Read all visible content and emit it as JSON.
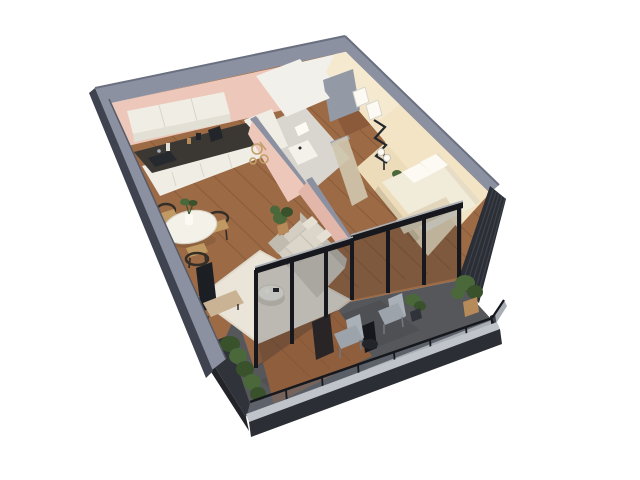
{
  "scene": {
    "kind": "isometric-3d-floorplan-render",
    "background": "#ffffff",
    "rooms": [
      {
        "name": "kitchen"
      },
      {
        "name": "dining-area"
      },
      {
        "name": "living-room"
      },
      {
        "name": "bathroom"
      },
      {
        "name": "entry-hall"
      },
      {
        "name": "bedroom"
      },
      {
        "name": "balcony"
      }
    ]
  },
  "colors": {
    "bg": "#ffffff",
    "wall_cap": "#8b91a1",
    "wall_cap_light": "#9ba1b0",
    "wall_side": "#3f434f",
    "wall_side_dark": "#262932",
    "pink": "#ecc7ba",
    "pink_shade": "#e2b6a9",
    "white_wall": "#f2f0ea",
    "cream": "#f2e4c4",
    "cream_light": "#f7efdb",
    "wood": "#9c6a45",
    "wood_line": "#7c5234",
    "entry_wood": "#8b5a3a",
    "bath_floor": "#d9d6d0",
    "bedroom_floor": "#eddcba",
    "balcony": "#56575b",
    "balcony_dark": "#3c3d41",
    "deck": "#8f5e3d",
    "frame": "#16181d",
    "glass": "rgba(25,30,42,0.22)",
    "rail_glass": "#636a76",
    "rail_cap": "#bfc3ca",
    "fascia": "#2b2e34",
    "slat": "#2b2e35",
    "slat_line": "#3d414a",
    "planter": "#303339",
    "planter_dark": "#222429",
    "plant": "#4a683a",
    "plant_dark": "#39522c",
    "pot_tan": "#b78a5a",
    "pot_white": "#f3f1ea",
    "sofa": "#d4cec2",
    "sofa_shade": "#c1bbaf",
    "cushion": "#dcd6ca",
    "pillow_small": "#e6e0d4",
    "rug": "#ebe5d9",
    "rug_border": "#dfd8ca",
    "table_white": "#f4f1e9",
    "table_edge": "#d9d4c6",
    "chair_dark": "#332e28",
    "chair_seat": "#c09a62",
    "counter_top": "#3b3834",
    "cabinet": "#f0ede5",
    "cabinet_shade": "#e2dfd5",
    "cabinet_seam": "#d8d5cb",
    "sink": "#26292e",
    "tv": "#1b1e23",
    "console": "#cab394",
    "bed": "#f1ebda",
    "pillow": "#fcfaf3",
    "blanket": "#e2d6bc",
    "headboard": "#e7ddc6",
    "dresser": "#f3f1ea",
    "metal": "#aab0b8",
    "metal_dark": "#9da3ab",
    "metal_leg": "#70767e",
    "door_gray": "#949aa5",
    "gold": "#c2a06a",
    "shower": "#cfc6ac",
    "appliance": "#22252a",
    "shadow": "rgba(40,30,20,0.12)"
  }
}
